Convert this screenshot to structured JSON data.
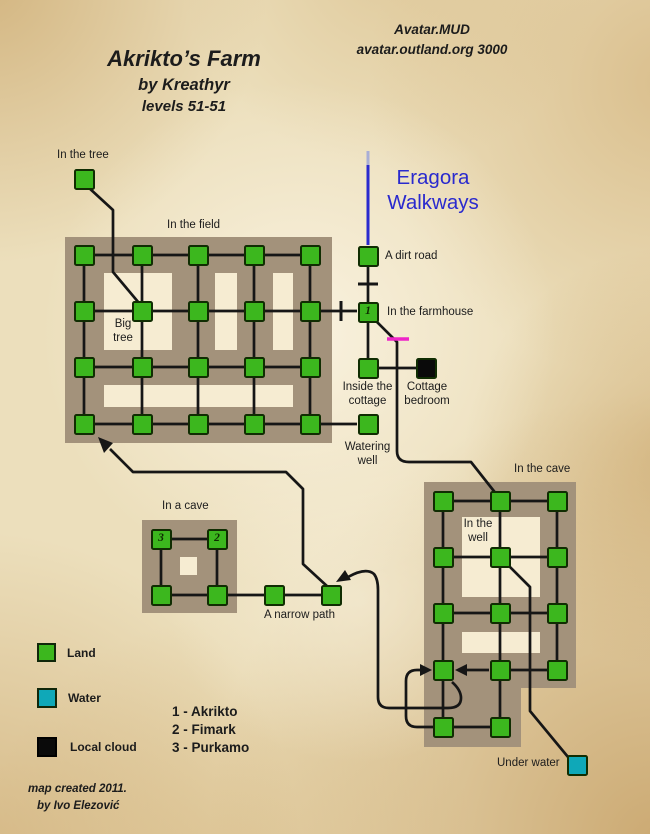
{
  "header": {
    "title": "Akrikto’s Farm",
    "byline": "by Kreathyr",
    "levels": "levels 51-51",
    "brand_line1": "Avatar.MUD",
    "brand_line2": "avatar.outland.org 3000"
  },
  "walkways": {
    "line1": "Eragora",
    "line2": "Walkways"
  },
  "labels": {
    "in_the_tree": "In the tree",
    "in_the_field": "In the field",
    "big_tree_l1": "Big",
    "big_tree_l2": "tree",
    "dirt_road": "A dirt road",
    "farmhouse": "In the farmhouse",
    "cottage_l1": "Inside the",
    "cottage_l2": "cottage",
    "bedroom_l1": "Cottage",
    "bedroom_l2": "bedroom",
    "watering_l1": "Watering",
    "watering_l2": "well",
    "cave_region": "In the cave",
    "in_well_l1": "In the",
    "in_well_l2": "well",
    "small_cave": "In a cave",
    "narrow_path": "A narrow path",
    "under_water": "Under water"
  },
  "markers": {
    "akrikto": "1",
    "fimark": "2",
    "purkamo": "3"
  },
  "legend": {
    "items": [
      {
        "label": "Land",
        "color": "#3cb71e"
      },
      {
        "label": "Water",
        "color": "#0fa8b8"
      },
      {
        "label": "Local cloud",
        "color": "#0a0a0a"
      }
    ],
    "npcs": [
      "1 - Akrikto",
      "2 - Fimark",
      "3 - Purkamo"
    ]
  },
  "credit": {
    "line1": "map created 2011.",
    "line2": "by Ivo Elezović"
  },
  "colors": {
    "walkway_blue": "#2a2ace",
    "walkway_blue_faded": "#a9aed6",
    "door_magenta": "#ee25c8",
    "region_brown": "#a3927b",
    "cutout_cream": "#f6ecd2",
    "line_black": "#161616",
    "land_green": "#3cb71e",
    "water_teal": "#0fa8b8",
    "cloud_black": "#0a0a0a"
  }
}
